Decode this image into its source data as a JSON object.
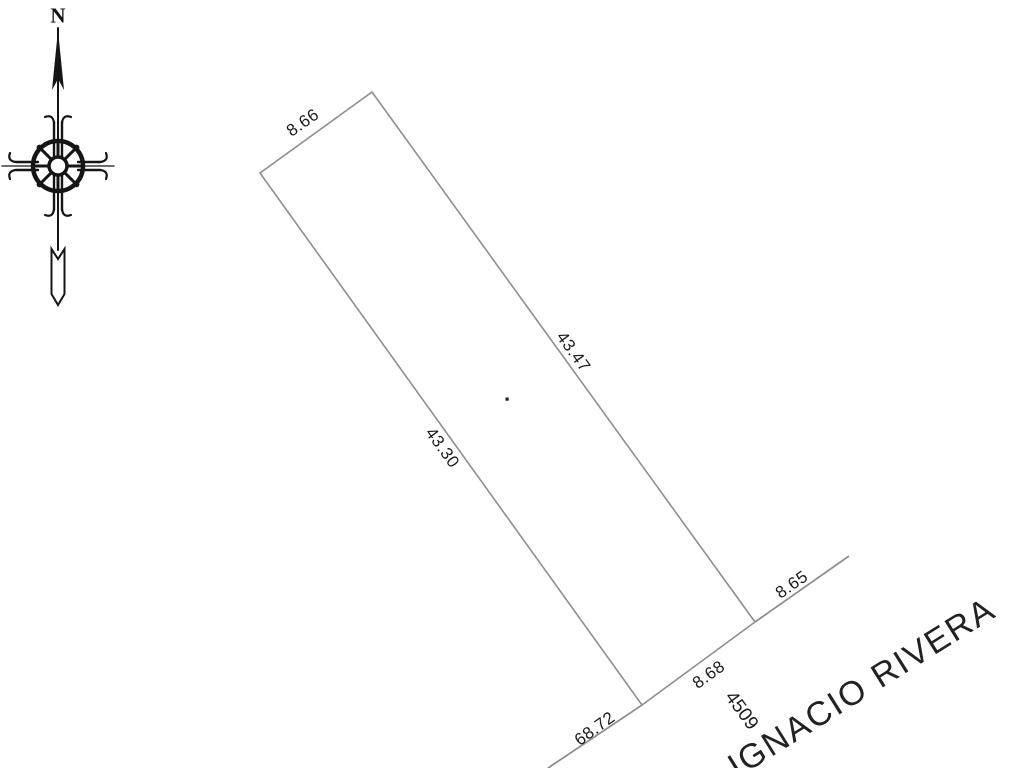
{
  "compass": {
    "north_label": "N"
  },
  "parcel": {
    "side_lengths": {
      "top": "8.66",
      "right": "43.47",
      "left": "43.30",
      "front": "8.68"
    },
    "lot_number": "4509"
  },
  "street": {
    "name": "IGNACIO RIVERA",
    "distance_left_along_street": "68.72",
    "distance_right_along_street": "8.65"
  },
  "colors": {
    "boundary_line_gray": "#8f8f8f",
    "ink_black": "#1c1c1c",
    "background": "#ffffff"
  }
}
